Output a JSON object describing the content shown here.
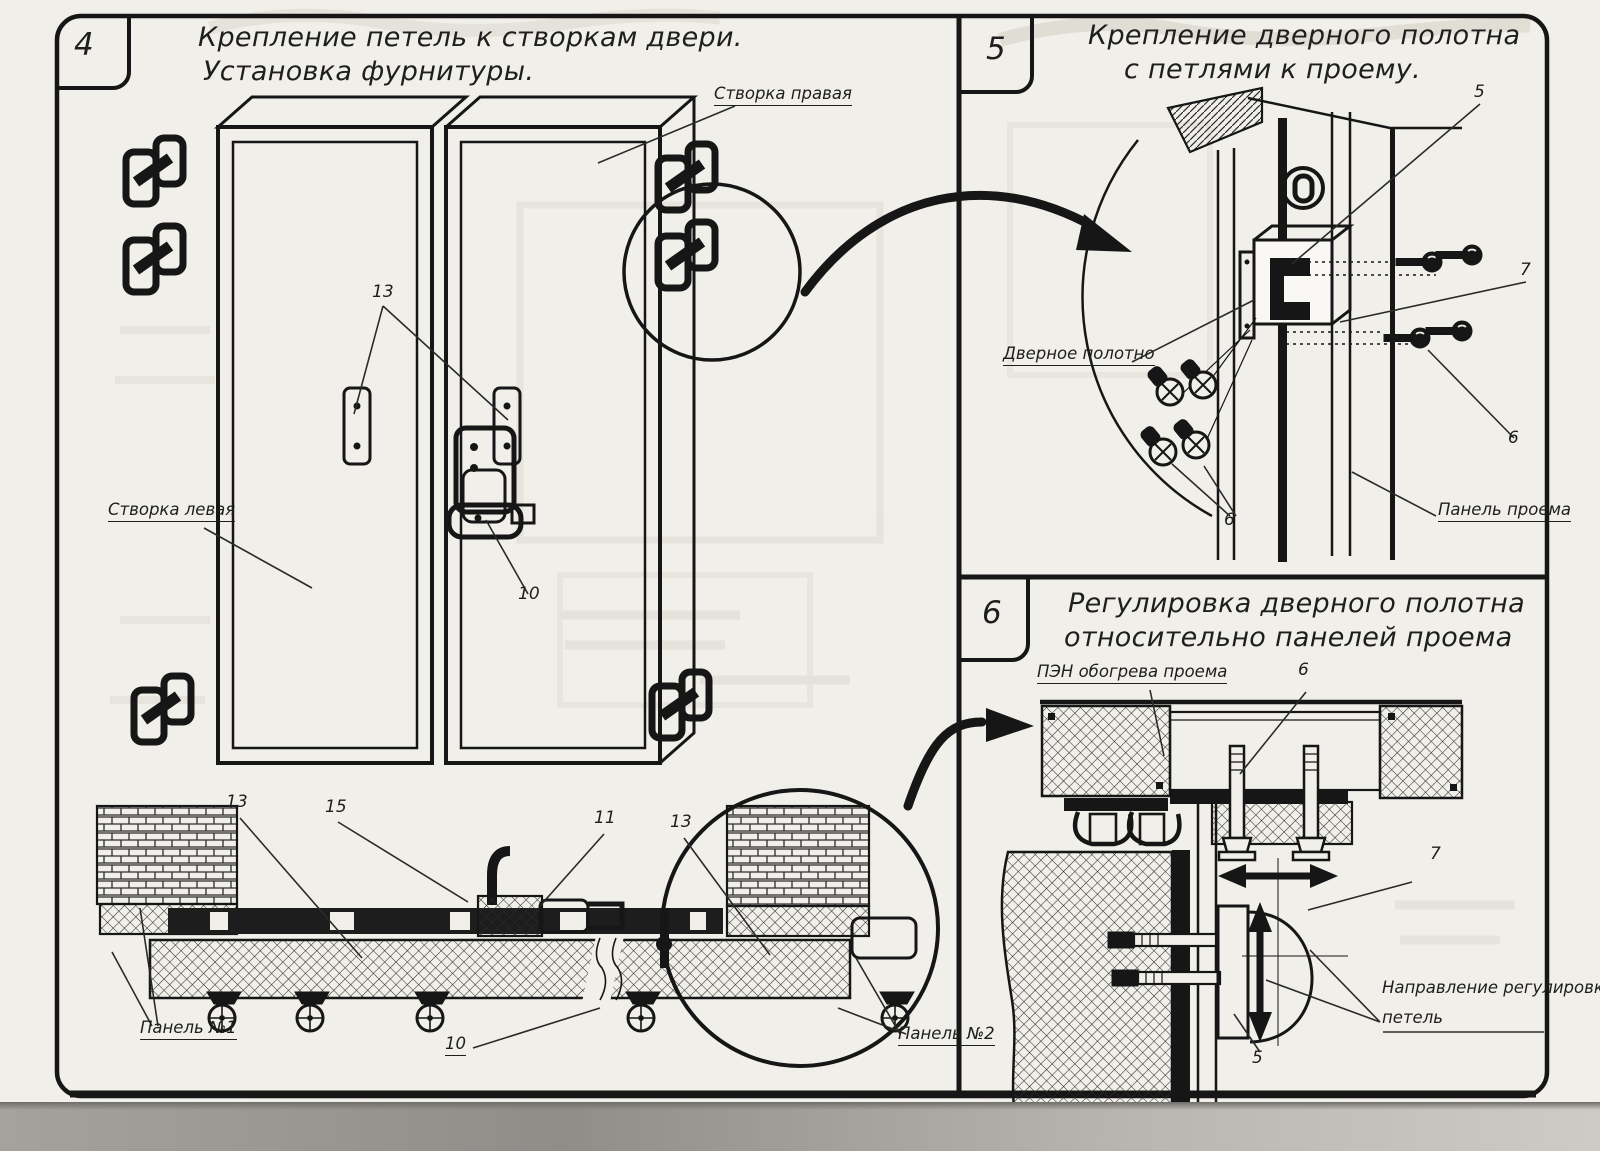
{
  "panel4": {
    "number": "4",
    "title": [
      "Крепление петель к створкам двери.",
      "Установка фурнитуры."
    ],
    "labels": {
      "leaf_right": "Створка правая",
      "leaf_left": "Створка левая",
      "panel1": "Панель №1",
      "panel2": "Панель №2"
    },
    "callouts": {
      "hinge_plates": "13",
      "handle": "10",
      "frame_left": "13",
      "lever": "15",
      "bracket": "11",
      "frame_right": "13",
      "latch_bottom": "10"
    }
  },
  "panel5": {
    "number": "5",
    "title": [
      "Крепление дверного полотна",
      "с петлями к проему."
    ],
    "labels": {
      "door_leaf": "Дверное полотно",
      "opening_panel": "Панель проема"
    },
    "callouts": {
      "hinge": "5",
      "screw_pack": "7",
      "screw_right": "6",
      "screws_left": "6"
    }
  },
  "panel6": {
    "number": "6",
    "title": [
      "Регулировка дверного полотна",
      "относительно панелей проема"
    ],
    "labels": {
      "pen": "ПЭН обогрева проема",
      "direction1": "Направление регулировки",
      "direction2": "петель"
    },
    "callouts": {
      "bolt": "6",
      "hinge_screw": "7",
      "hinge_plate": "5"
    }
  }
}
